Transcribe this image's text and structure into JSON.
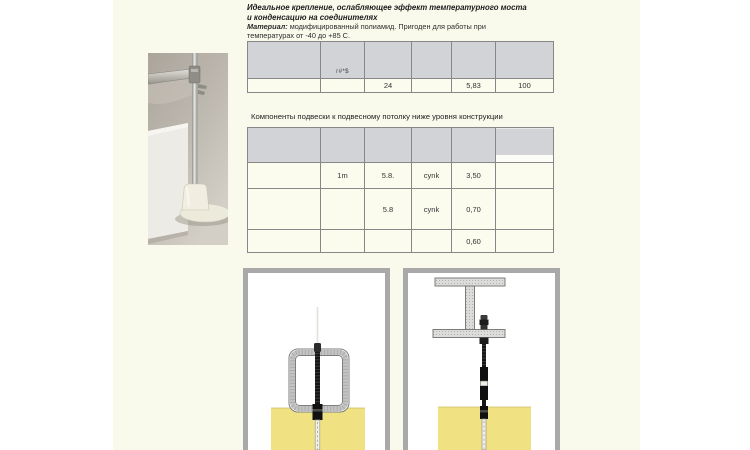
{
  "colors": {
    "page_background": "#ffffff",
    "content_band": "#fafaec",
    "table_header": "#d2d3d6",
    "table_body": "#fbfbee",
    "panel_border": "#a9a9a9",
    "insulation_yellow": "#f0e282",
    "beam_gray": "#dcdcda"
  },
  "intro": {
    "title_line1": "Идеальное крепление, ослабляющее эффект температурного моста",
    "title_line2": "и конденсацию на соединителях",
    "material_label": "Материал:",
    "material_line1_rest": " модифицированный полиамид. Пригоден для работы при",
    "material_line2": "температурах от -40 до +85 С."
  },
  "spec_table": {
    "header_note": "г#*$",
    "row": [
      "",
      "",
      "24",
      "",
      "5,83",
      "100"
    ]
  },
  "components_table": {
    "title": "Компоненты подвески к подвесному потолку ниже уровня конструкции",
    "rows": [
      [
        "",
        "1m",
        "5.8.",
        "cynk",
        "3,50",
        ""
      ],
      [
        "",
        "",
        "5.8",
        "cynk",
        "0,70",
        ""
      ],
      [
        "",
        "",
        "",
        "",
        "0,60",
        ""
      ]
    ]
  }
}
